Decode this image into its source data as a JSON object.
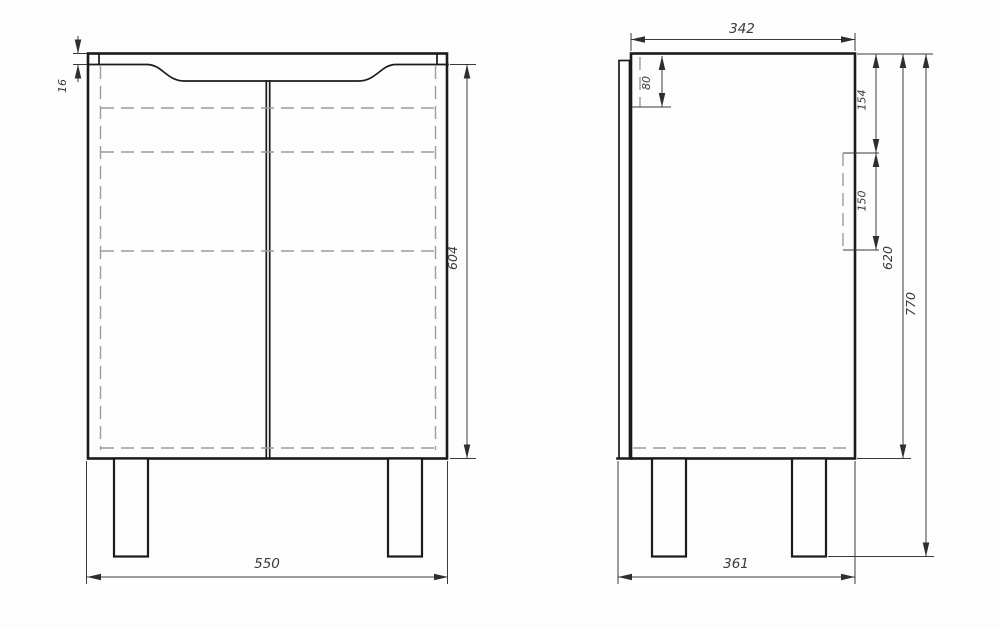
{
  "colors": {
    "bg": "#fdfdfd",
    "line": "#1b1b1b",
    "dim": "#3a3a3a",
    "hidden": "#9c9c9c",
    "text": "#3a3a3a"
  },
  "front_view": {
    "dimensions": {
      "countertop_thickness": "16",
      "body_height": "604",
      "width": "550"
    }
  },
  "side_view": {
    "dimensions": {
      "top_depth": "342",
      "sink_recess_depth": "80",
      "back_cutout_top_offset": "154",
      "back_cutout_height": "150",
      "cabinet_height": "620",
      "overall_height": "770",
      "overall_depth": "361"
    }
  }
}
